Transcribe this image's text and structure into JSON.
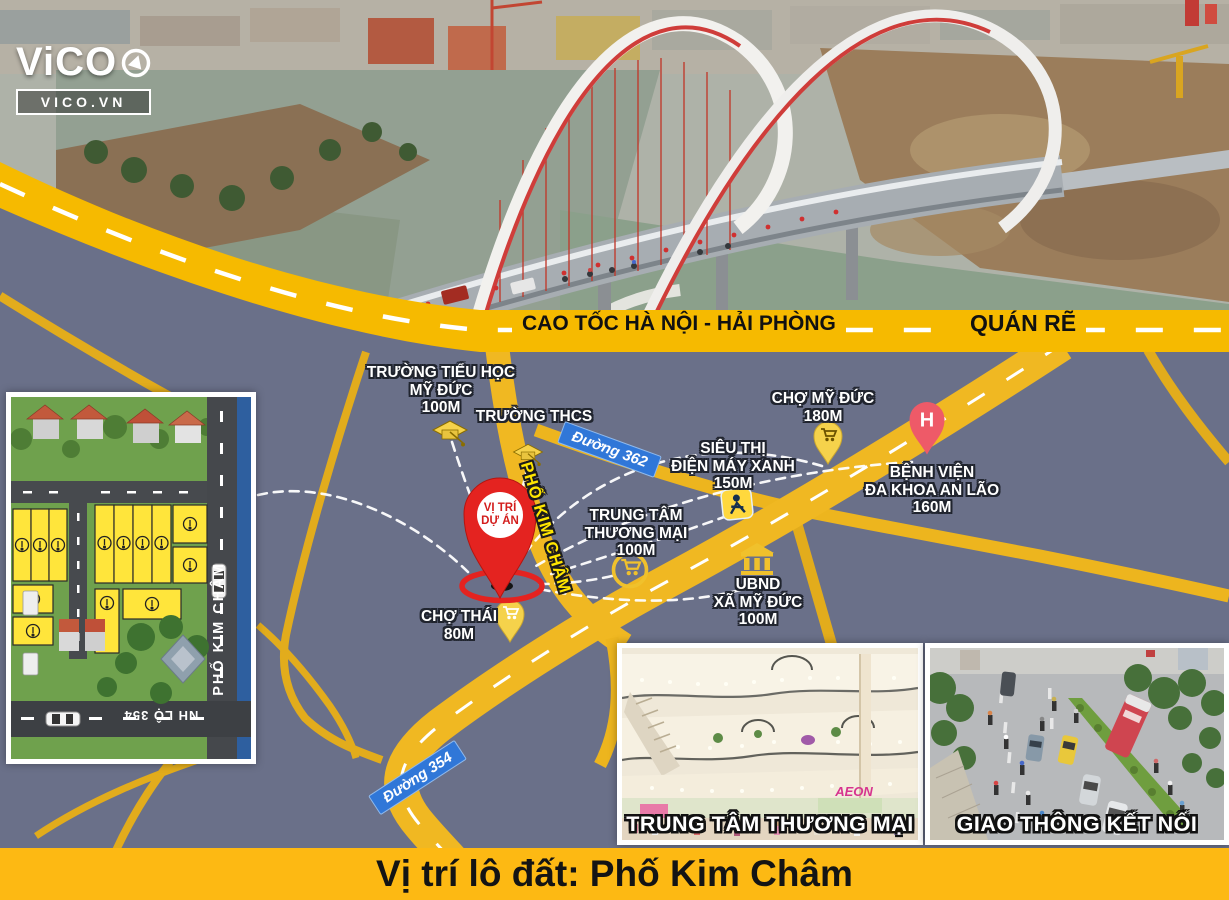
{
  "brand": {
    "logo": "ViCO",
    "logo_sub": "VICO.VN"
  },
  "highway": {
    "left_label": "CAO TỐC HÀ NỘI - HẢI PHÒNG",
    "right_label": "QUÁN RẼ"
  },
  "signs": {
    "d362": "Đường 362",
    "d354": "Đường 354"
  },
  "map": {
    "street_label": "PHỐ KIM CHÂM",
    "project_marker": {
      "lines": [
        "VỊ TRÍ",
        "DỰ ÁN"
      ]
    },
    "pois": [
      {
        "id": "truong-tieu-hoc-my-duc",
        "icon": "graduation-cap",
        "lines": [
          "TRƯỜNG TIỂU HỌC",
          "MỸ ĐỨC",
          "100M"
        ]
      },
      {
        "id": "truong-thcs",
        "icon": "graduation-cap",
        "lines": [
          "TRƯỜNG THCS"
        ]
      },
      {
        "id": "cho-my-duc",
        "icon": "market-pin",
        "lines": [
          "CHỢ MỸ ĐỨC",
          "180M"
        ]
      },
      {
        "id": "sieu-thi-dien-may-xanh",
        "icon": "dien-may-xanh-badge",
        "lines": [
          "SIÊU THỊ",
          "ĐIỆN MÁY XANH",
          "150M"
        ]
      },
      {
        "id": "benh-vien-da-khoa-an-lao",
        "icon": "hospital-pin",
        "pin_letter": "H",
        "lines": [
          "BỆNH VIỆN",
          "ĐA KHOA AN LÃO",
          "160M"
        ]
      },
      {
        "id": "trung-tam-thuong-mai",
        "icon": "cart-circle",
        "lines": [
          "TRUNG TÂM",
          "THƯƠNG MẠI",
          "100M"
        ]
      },
      {
        "id": "ubnd-xa-my-duc",
        "icon": "government-building",
        "lines": [
          "UBND",
          "XÃ MỸ ĐỨC",
          "100M"
        ]
      },
      {
        "id": "cho-thai",
        "icon": "market-pin",
        "lines": [
          "CHỢ THÁI",
          "80M"
        ]
      }
    ]
  },
  "site_plan": {
    "street_label": "PHỐ KIM CHÂM",
    "road_label": "NH LỘ 354"
  },
  "insets": [
    {
      "caption": "TRUNG TÂM THƯƠNG MẠI",
      "sign": "AEON"
    },
    {
      "caption": "GIAO THÔNG KẾT NỐI"
    }
  ],
  "footer": {
    "title": "Vị trí lô đất: Phố Kim Châm"
  },
  "colors": {
    "band_yellow": "#f6ba00",
    "road_yellow": "#edb51e",
    "map_bg": "#6a7089",
    "pin_red": "#e42320",
    "hospital_pin": "#ee5a68",
    "sign_blue": "#3077d8",
    "footer_yellow": "#fdb913",
    "plot_yellow": "#ffe53b"
  }
}
